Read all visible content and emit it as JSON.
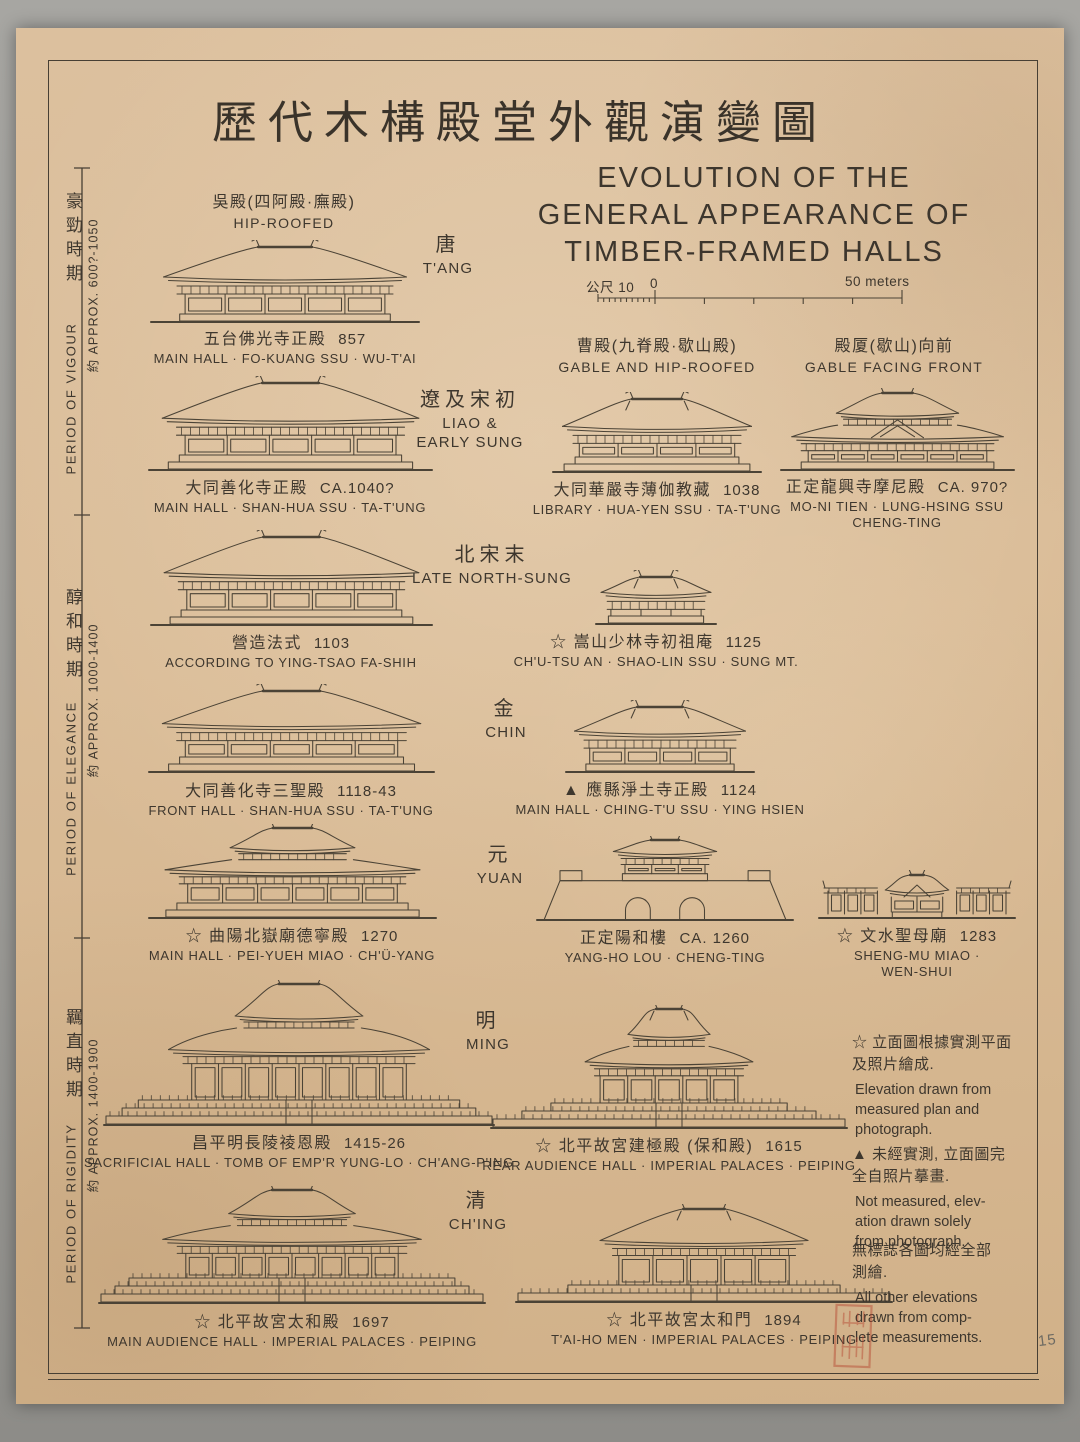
{
  "title": {
    "zh": "歷代木構殿堂外觀演變圖",
    "en_lines": [
      "EVOLUTION OF THE",
      "GENERAL APPEARANCE OF",
      "TIMBER-FRAMED HALLS"
    ]
  },
  "scale_bar": {
    "unit_label": "公尺 10",
    "zero_label": "0",
    "end_label": "50 meters"
  },
  "periods": [
    {
      "zh": "豪勁時期",
      "en": "PERIOD OF VIGOUR",
      "approx": "約 APPROX. 600?-1050"
    },
    {
      "zh": "醇和時期",
      "en": "PERIOD OF ELEGANCE",
      "approx": "約 APPROX. 1000-1400"
    },
    {
      "zh": "羈直時期",
      "en": "PERIOD OF RIGIDITY",
      "approx": "約 APPROX. 1400-1900"
    }
  ],
  "roof_types": [
    {
      "zh": "吳殿(四阿殿·廡殿)",
      "en": "HIP-ROOFED"
    },
    {
      "zh": "曹殿(九脊殿·歇山殿)",
      "en": "GABLE AND HIP-ROOFED"
    },
    {
      "zh": "殿厦(歇山)向前",
      "en": "GABLE FACING FRONT"
    }
  ],
  "dynasties": [
    {
      "zh": "唐",
      "en": "T'ANG"
    },
    {
      "zh": "遼及宋初",
      "en": "LIAO &\nEARLY SUNG"
    },
    {
      "zh": "北宋末",
      "en": "LATE NORTH-SUNG"
    },
    {
      "zh": "金",
      "en": "CHIN"
    },
    {
      "zh": "元",
      "en": "YUAN"
    },
    {
      "zh": "明",
      "en": "MING"
    },
    {
      "zh": "清",
      "en": "CH'ING"
    }
  ],
  "buildings": [
    {
      "zh": "五台佛光寺正殿",
      "date": "857",
      "en": "MAIN HALL · FO-KUANG SSU · WU-T'AI"
    },
    {
      "zh": "大同善化寺正殿",
      "date": "CA.1040?",
      "en": "MAIN HALL · SHAN-HUA SSU · TA-T'UNG"
    },
    {
      "zh": "大同華嚴寺薄伽教藏",
      "date": "1038",
      "en": "LIBRARY · HUA-YEN SSU · TA-T'UNG"
    },
    {
      "zh": "正定龍興寺摩尼殿",
      "date": "CA. 970?",
      "en": "MO-NI TIEN · LUNG-HSING SSU\nCHENG-TING"
    },
    {
      "zh": "營造法式",
      "date": "1103",
      "en": "ACCORDING TO YING-TSAO FA-SHIH"
    },
    {
      "zh": "☆ 嵩山少林寺初祖庵",
      "date": "1125",
      "en": "CH'U-TSU AN · SHAO-LIN SSU · SUNG MT."
    },
    {
      "zh": "大同善化寺三聖殿",
      "date": "1118-43",
      "en": "FRONT HALL · SHAN-HUA SSU · TA-T'UNG"
    },
    {
      "zh": "▲ 應縣淨土寺正殿",
      "date": "1124",
      "en": "MAIN HALL · CHING-T'U SSU · YING HSIEN"
    },
    {
      "zh": "☆ 曲陽北嶽廟德寧殿",
      "date": "1270",
      "en": "MAIN HALL · PEI-YUEH MIAO · CH'Ü-YANG"
    },
    {
      "zh": "正定陽和樓",
      "date": "CA. 1260",
      "en": "YANG-HO LOU · CHENG-TING"
    },
    {
      "zh": "☆ 文水聖母廟",
      "date": "1283",
      "en": "SHENG-MU MIAO · WEN-SHUI"
    },
    {
      "zh": "昌平明長陵祾恩殿",
      "date": "1415-26",
      "en": "SACRIFICIAL HALL · TOMB OF EMP'R YUNG-LO · CH'ANG-P'ING"
    },
    {
      "zh": "☆ 北平故宮建極殿 (保和殿)",
      "date": "1615",
      "en": "REAR AUDIENCE HALL · IMPERIAL PALACES · PEIPING"
    },
    {
      "zh": "☆ 北平故宮太和殿",
      "date": "1697",
      "en": "MAIN AUDIENCE HALL · IMPERIAL PALACES · PEIPING"
    },
    {
      "zh": "☆ 北平故宮太和門",
      "date": "1894",
      "en": "T'AI-HO MEN · IMPERIAL PALACES · PEIPING"
    }
  ],
  "legend": {
    "items": [
      {
        "zh": "☆ 立面圖根據實測平面\n及照片繪成.",
        "en": "Elevation drawn from\nmeasured plan and\nphotograph."
      },
      {
        "zh": "▲ 未經實測, 立面圖完\n全自照片摹畫.",
        "en": "Not measured, elev-\nation drawn solely\nfrom photograph."
      },
      {
        "zh": "無標誌各圖均經全部\n測繪.",
        "en": "All other elevations\ndrawn from comp-\nlete measurements."
      }
    ]
  },
  "page_note": "15",
  "colors": {
    "ink": "#4b4336",
    "paper": "#dabc97",
    "seal_red": "#b4402c"
  }
}
